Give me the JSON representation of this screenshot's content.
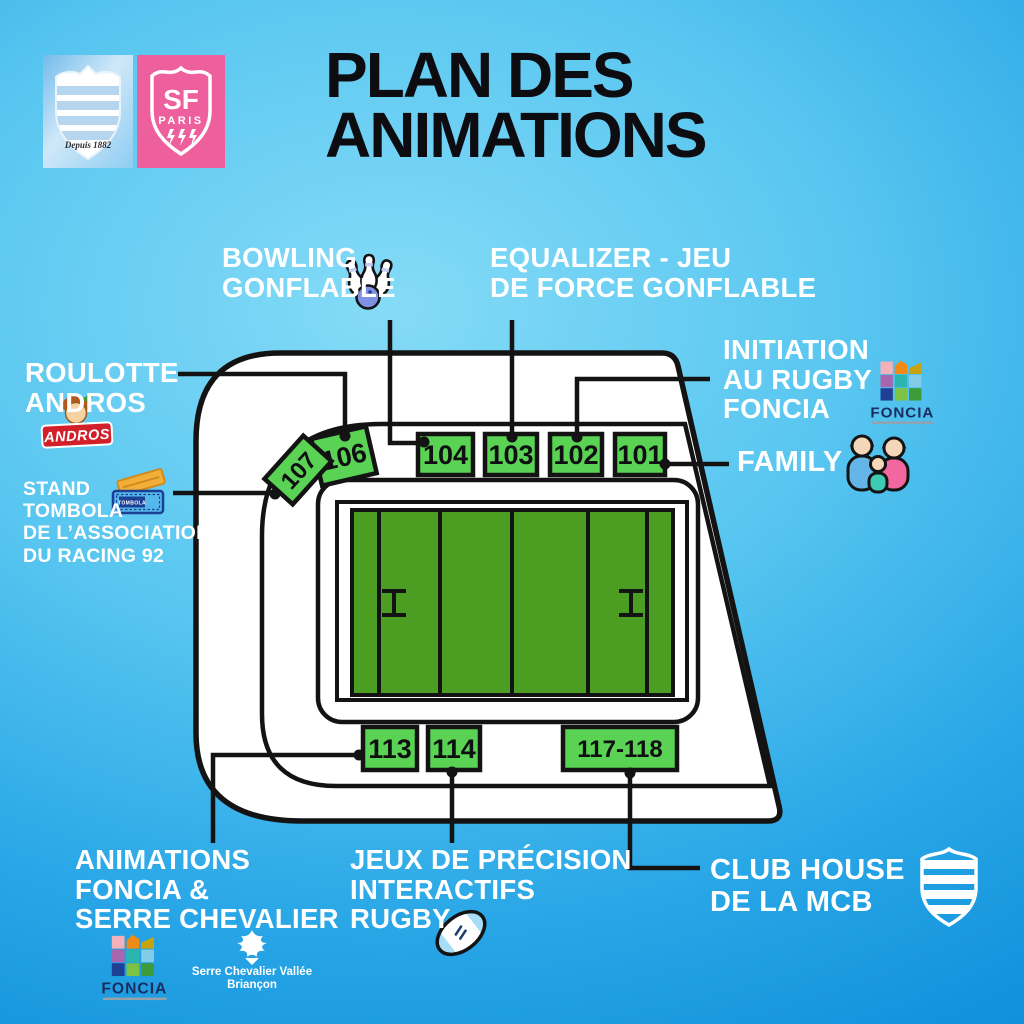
{
  "header": {
    "title_line1": "PLAN DES",
    "title_line2": "ANIMATIONS"
  },
  "logos": {
    "racing_motto": "Depuis 1882",
    "sf_abbr": "SF",
    "sf_city": "PARIS"
  },
  "labels": {
    "bowling": {
      "line1": "BOWLING",
      "line2": "GONFLABLE"
    },
    "equalizer": {
      "line1": "EQUALIZER - JEU",
      "line2": "DE FORCE GONFLABLE"
    },
    "roulotte": {
      "line1": "ROULOTTE",
      "line2": "ANDROS"
    },
    "tombola": {
      "line1": "STAND",
      "line2": "TOMBOLA",
      "line3": "DE L’ASSOCIATION",
      "line4": "DU RACING 92"
    },
    "initiation": {
      "line1": "INITIATION",
      "line2": "AU RUGBY",
      "line3": "FONCIA"
    },
    "family": {
      "line1": "FAMILY"
    },
    "animations": {
      "line1": "ANIMATIONS",
      "line2": "FONCIA &",
      "line3": "SERRE CHEVALIER"
    },
    "jeux": {
      "line1": "JEUX DE PRÉCISION",
      "line2": "INTERACTIFS",
      "line3": "RUGBY"
    },
    "clubhouse": {
      "line1": "CLUB HOUSE",
      "line2": "DE LA MCB"
    }
  },
  "stands": {
    "s101": "101",
    "s102": "102",
    "s103": "103",
    "s104": "104",
    "s106": "106",
    "s107": "107",
    "s113": "113",
    "s114": "114",
    "s117_118": "117-118"
  },
  "brands": {
    "foncia": "FONCIA",
    "andros": "ANDROS",
    "tombola_ticket": "TOMBOLA",
    "serre_line1": "Serre Chevalier Vallée",
    "serre_line2": "Briançon"
  },
  "colors": {
    "background_light": "#85dbf7",
    "background_deep": "#0e8bd6",
    "stand_green": "#5ad253",
    "pitch_green": "#4b9e22",
    "outline_black": "#131313",
    "label_white": "#ffffff",
    "title_black": "#0c0c11",
    "sf_pink": "#ee5f9d",
    "racing_stripe_blue": "#b5d6ee",
    "foncia_navy": "#1b2d5f",
    "andros_red": "#d2202a",
    "tombola_blue": "#54b9ea"
  }
}
